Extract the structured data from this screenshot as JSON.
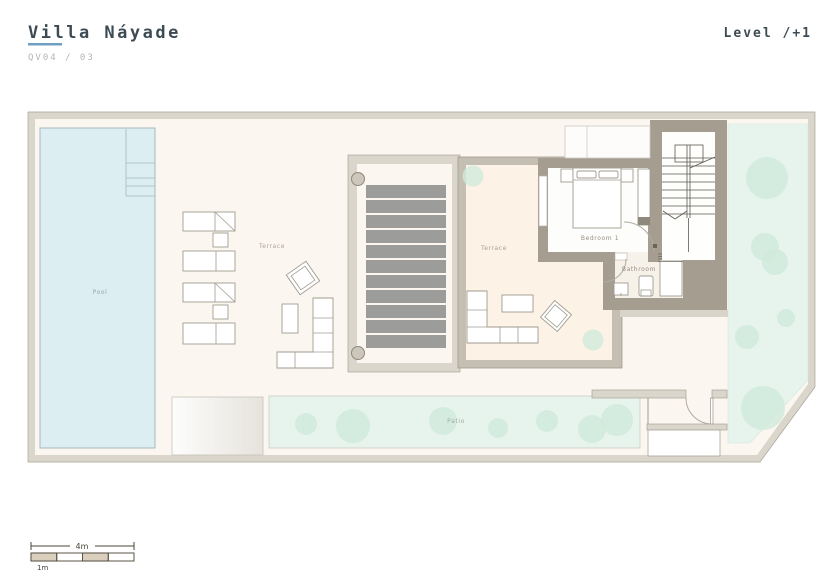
{
  "title_block": {
    "project": "Villa Náyade",
    "drawing_number": "QV04 / 03"
  },
  "level_indicator": "Level /+1",
  "rooms": {
    "pool": "Pool",
    "terrace_outdoor": "Terrace",
    "terrace_indoor": "Terrace",
    "bedroom": "Bedroom 1",
    "bathroom": "Bathroom",
    "patio": "Patio"
  },
  "scale_bar": {
    "total": "4m",
    "unit": "1m"
  },
  "colors": {
    "accent": "#6f9fc0",
    "heading": "#3d4b55",
    "muted": "#b4b4b2",
    "wall-dark": "#a59e90",
    "wall-light": "#dad6cc",
    "wall-line": "#aaa499",
    "floor-cream": "#fbf7f0",
    "floor-warm": "#fcf2e6",
    "pool": "#dceef2",
    "pool-line": "#a4b8be",
    "garden": "#e7f4ed",
    "plant": "#cfeadb",
    "slat": "#9c9c9a",
    "furniture-line": "#a19b90",
    "label": "#a8a195",
    "label-cool": "#98a7ac",
    "label-green": "#9dac9e",
    "label-dark": "#958e81",
    "scale-line": "#4a4437",
    "scale-fill": "#d9cfbc"
  }
}
